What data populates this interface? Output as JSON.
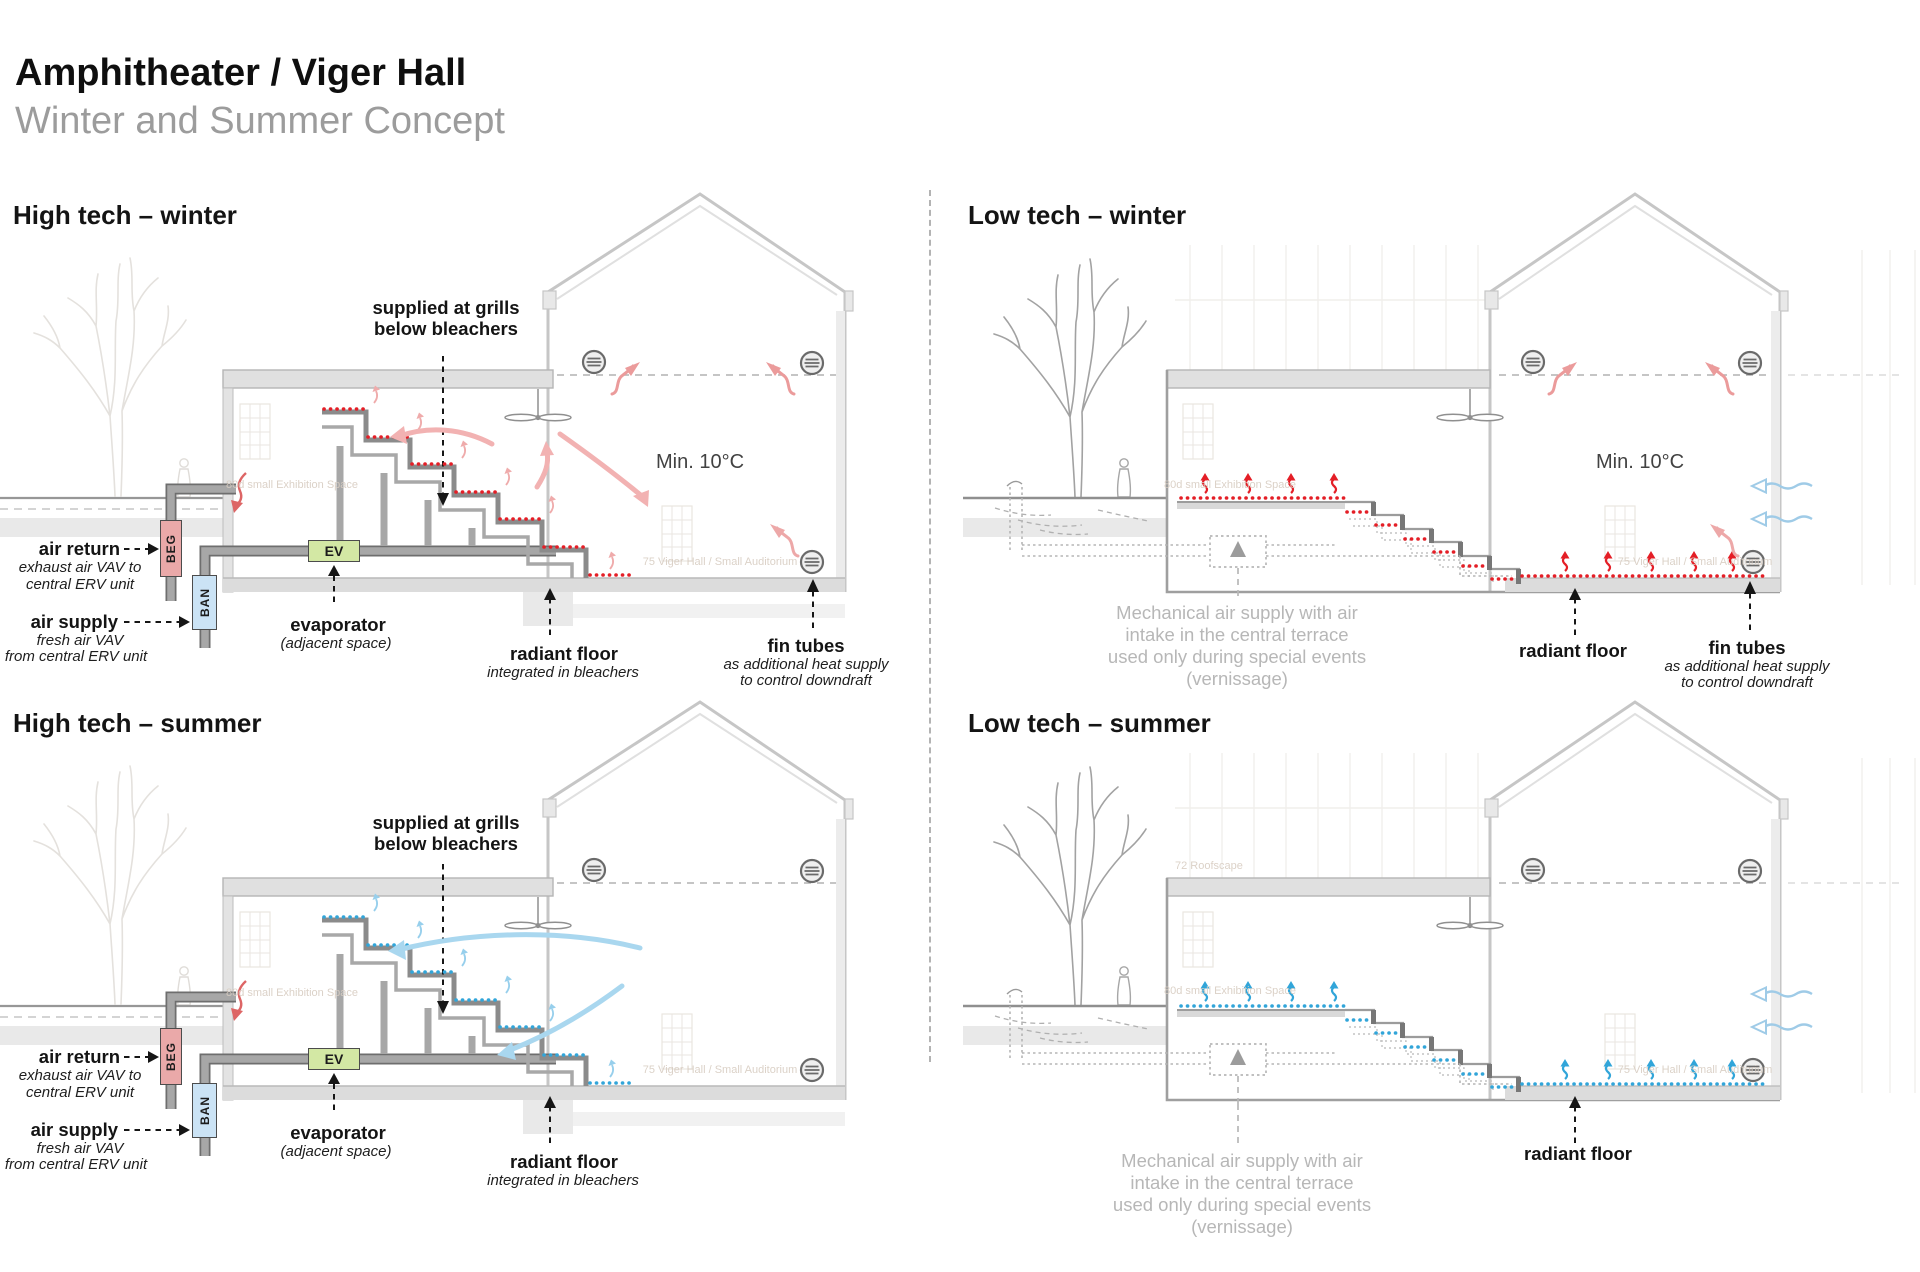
{
  "header": {
    "title": "Amphitheater / Viger Hall",
    "subtitle": "Winter and Summer Concept"
  },
  "colors": {
    "radiant_hot": "#e41e26",
    "radiant_cool": "#31a5d9",
    "flow_warm": "#f2b2b2",
    "flow_cool": "#a9d7ef",
    "beg_fill": "#eaa9a9",
    "ban_fill": "#cbe3f5",
    "ev_fill": "#d3e8a4"
  },
  "quadrants": {
    "high_tech_winter": {
      "heading": "High tech – winter",
      "supplied_line1": "supplied at grills",
      "supplied_line2": "below bleachers",
      "min_temp": "Min. 10°C",
      "air_return": {
        "label": "air return",
        "sub1": "exhaust air VAV to",
        "sub2": "central ERV unit"
      },
      "air_supply": {
        "label": "air supply",
        "sub1": "fresh air VAV",
        "sub2": "from central ERV unit"
      },
      "evaporator": {
        "label": "evaporator",
        "sub": "(adjacent space)"
      },
      "radiant_floor": {
        "label": "radiant floor",
        "sub": "integrated in bleachers"
      },
      "fin_tubes": {
        "label": "fin tubes",
        "sub1": "as additional heat supply",
        "sub2": "to control downdraft"
      },
      "boxes": {
        "beg": "BEG",
        "ban": "BAN",
        "ev": "EV"
      },
      "bg_text1": "80d small Exhibition Space",
      "bg_text2": "75 Viger Hall / Small Auditorium"
    },
    "low_tech_winter": {
      "heading": "Low tech – winter",
      "min_temp": "Min. 10°C",
      "mechanical_supply": {
        "line1": "Mechanical air supply with air",
        "line2": "intake in the central terrace",
        "line3": "used only during special events",
        "line4": "(vernissage)"
      },
      "radiant_floor": {
        "label": "radiant floor"
      },
      "fin_tubes": {
        "label": "fin tubes",
        "sub1": "as additional heat supply",
        "sub2": "to control downdraft"
      },
      "bg_text1": "80d small Exhibition Space",
      "bg_text2": "75 Viger Hall / Small Auditorium"
    },
    "high_tech_summer": {
      "heading": "High tech – summer",
      "supplied_line1": "supplied at grills",
      "supplied_line2": "below bleachers",
      "air_return": {
        "label": "air return",
        "sub1": "exhaust air VAV to",
        "sub2": "central ERV unit"
      },
      "air_supply": {
        "label": "air supply",
        "sub1": "fresh air VAV",
        "sub2": "from central ERV unit"
      },
      "evaporator": {
        "label": "evaporator",
        "sub": "(adjacent space)"
      },
      "radiant_floor": {
        "label": "radiant floor",
        "sub": "integrated in bleachers"
      },
      "boxes": {
        "beg": "BEG",
        "ban": "BAN",
        "ev": "EV"
      },
      "bg_text1": "80d small Exhibition Space",
      "bg_text2": "75 Viger Hall / Small Auditorium"
    },
    "low_tech_summer": {
      "heading": "Low tech – summer",
      "mechanical_supply": {
        "line1": "Mechanical air supply with air",
        "line2": "intake in the central terrace",
        "line3": "used only during special events",
        "line4": "(vernissage)"
      },
      "radiant_floor": {
        "label": "radiant floor"
      },
      "bg_text1": "80d small Exhibition Space",
      "bg_text2": "75 Viger Hall / Small Auditorium",
      "bg_text3": "72 Roofscape"
    }
  }
}
